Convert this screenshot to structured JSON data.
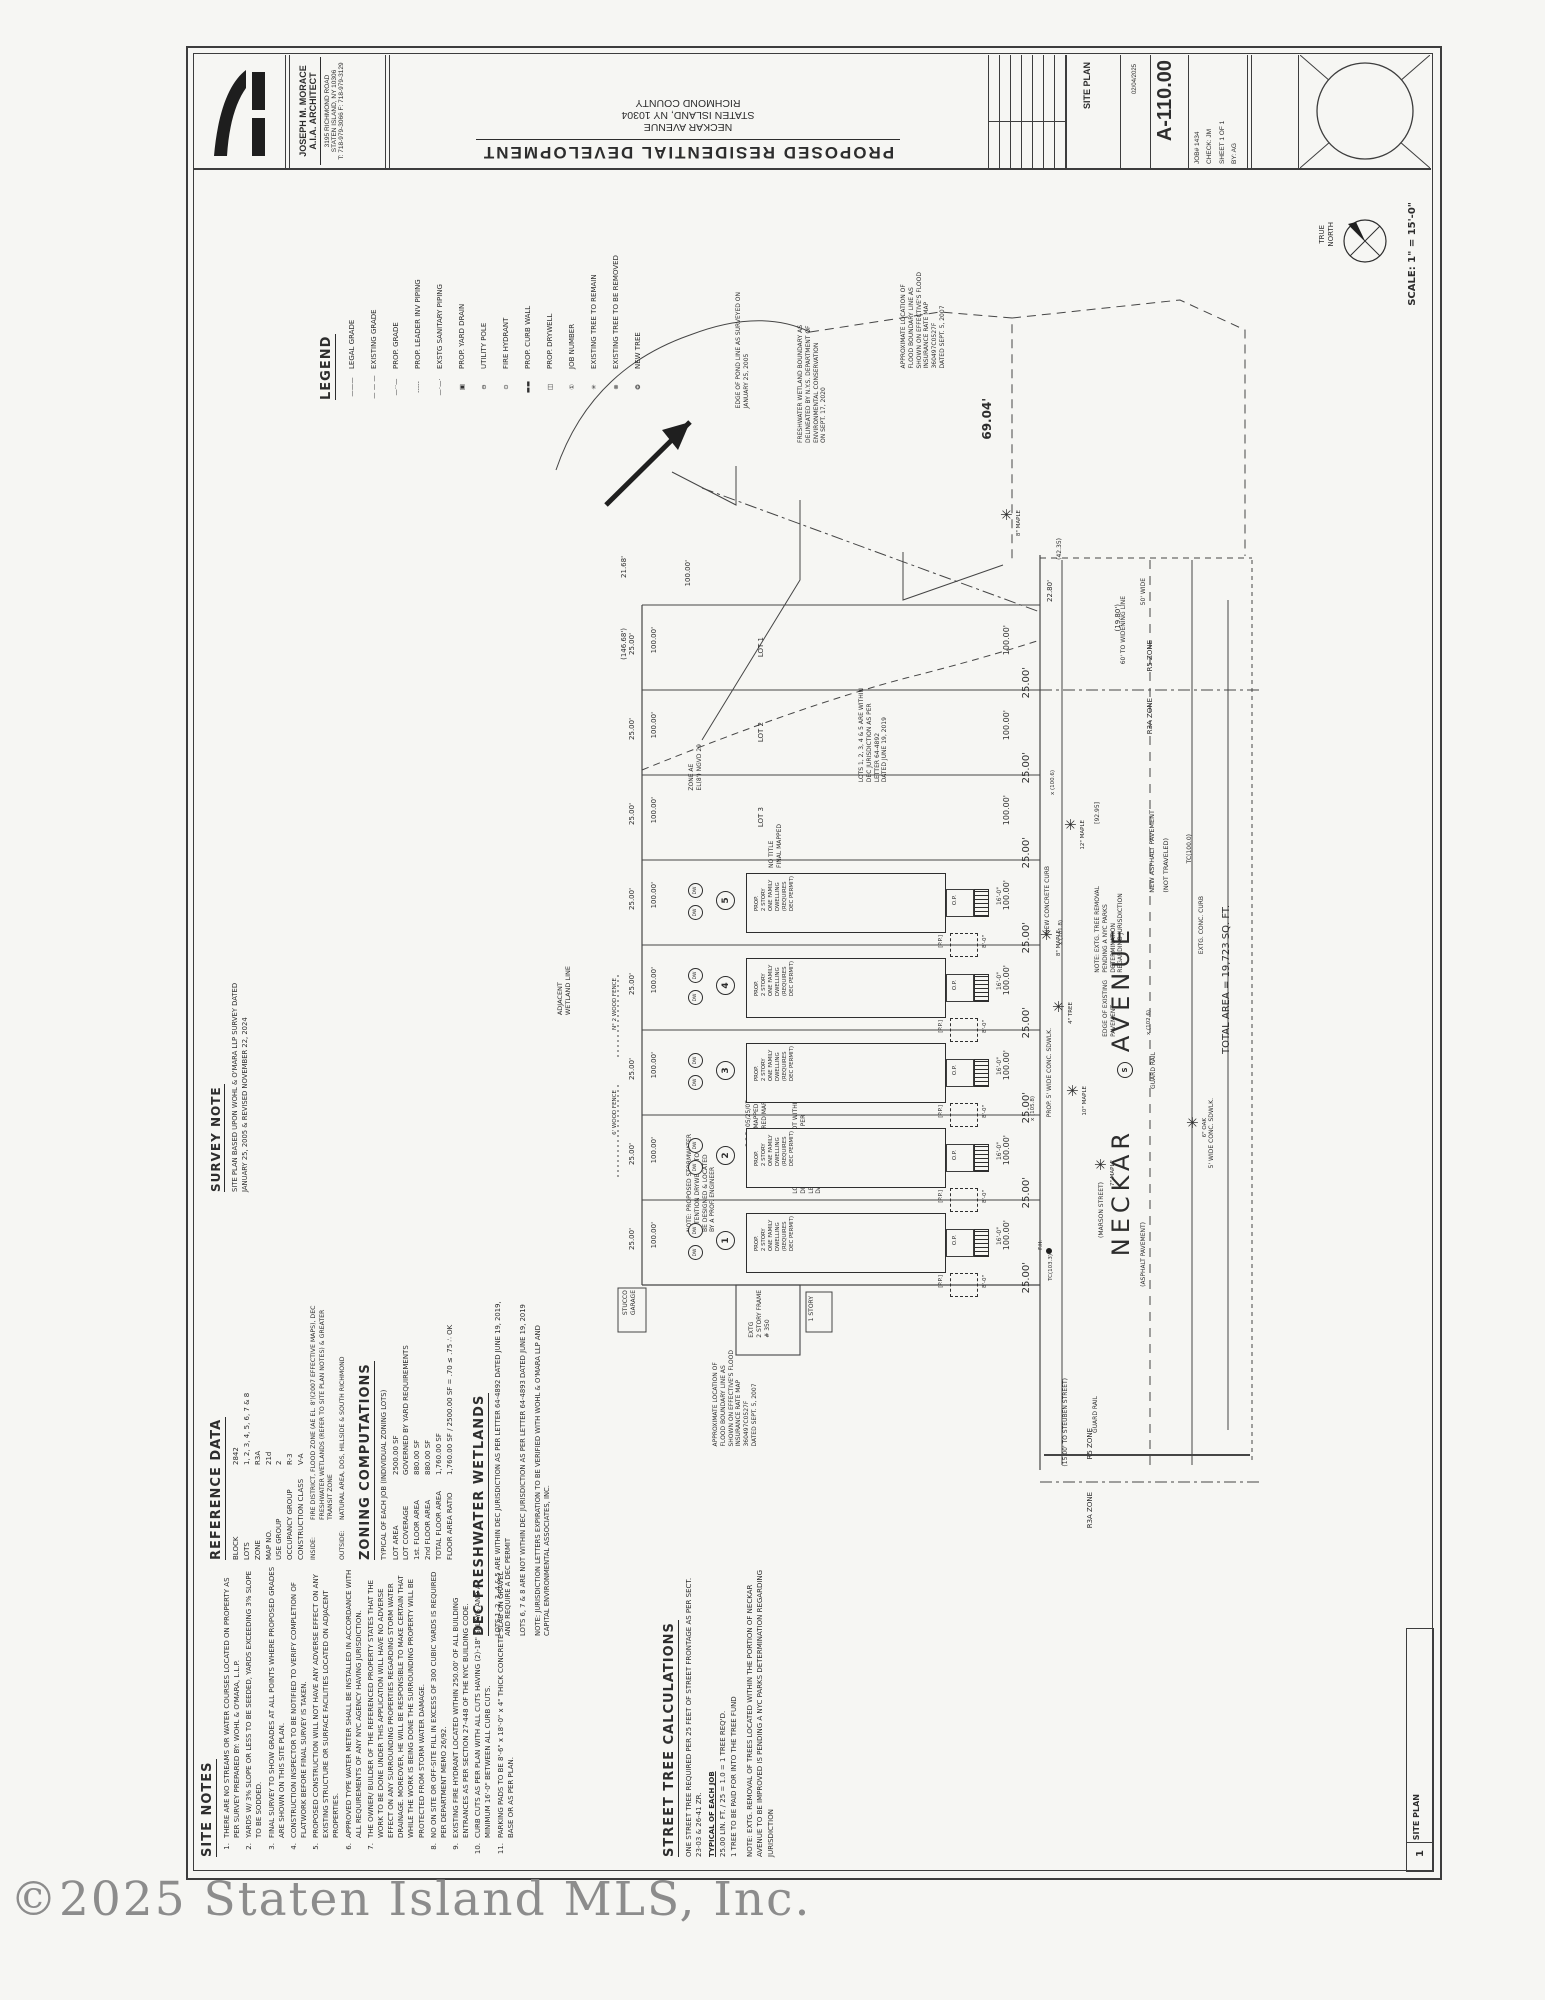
{
  "title_block": {
    "architect": {
      "name": "JOSEPH M. MORACE",
      "title": "A.I.A. ARCHITECT",
      "address1": "3195 RICHMOND ROAD",
      "address2": "STATEN ISLAND, NY 10306",
      "address3": "T: 718-979-3066   F: 718-979-3129"
    },
    "project": {
      "title": "PROPOSED  RESIDENTIAL  DEVELOPMENT",
      "address_lines": [
        "NECKAR AVENUE",
        "STATEN ISLAND, NY 10304",
        "RICHMOND COUNTY"
      ]
    },
    "site_plan_label": "SITE PLAN",
    "date": "02/04/2025",
    "sheet_number": "A-110.00",
    "job_lines": [
      "JOB# 1434",
      "CHECK: JM",
      "SHEET 1 OF 1",
      "BY: AG"
    ]
  },
  "legend": {
    "header": "LEGEND",
    "items": [
      {
        "sym": "———",
        "label": "LEGAL GRADE"
      },
      {
        "sym": "— — —",
        "label": "EXISTING GRADE"
      },
      {
        "sym": "—··—",
        "label": "PROP. GRADE"
      },
      {
        "sym": "-----",
        "label": "PROP. LEADER INV PIPING"
      },
      {
        "sym": "—·—·",
        "label": "EXSTG SANITARY PIPING"
      },
      {
        "sym": "▣",
        "label": "PROP. YARD DRAIN"
      },
      {
        "sym": "⊖",
        "label": "UTILITY POLE"
      },
      {
        "sym": "⊙",
        "label": "FIRE HYDRANT"
      },
      {
        "sym": "▬▬",
        "label": "PROP. CURB WALL"
      },
      {
        "sym": "◫",
        "label": "PROP. DRYWELL"
      },
      {
        "sym": "①",
        "label": "JOB NUMBER"
      },
      {
        "sym": "✳",
        "label": "EXISTING TREE TO REMAIN"
      },
      {
        "sym": "⊗",
        "label": "EXISTING TREE TO BE REMOVED"
      },
      {
        "sym": "❂",
        "label": "NEW TREE"
      }
    ]
  },
  "survey_note": {
    "header": "SURVEY NOTE",
    "text": "SITE PLAN BASED UPON WOHL & O'MARA LLP SURVEY DATED\nJANUARY 25, 2005 & REVISED NOVEMBER 22, 2024"
  },
  "reference_data": {
    "header": "REFERENCE DATA",
    "rows": [
      {
        "label": "BLOCK",
        "value": "2842"
      },
      {
        "label": "LOTS",
        "value": "1, 2, 3, 4, 5, 6, 7 & 8"
      },
      {
        "label": "ZONE",
        "value": "R3A"
      },
      {
        "label": "MAP NO.",
        "value": "21d"
      },
      {
        "label": "USE GROUP",
        "value": "2"
      },
      {
        "label": "OCCUPANCY GROUP",
        "value": "R-3"
      },
      {
        "label": "CONSTRUCTION CLASS",
        "value": "V-A"
      }
    ],
    "inside_label": "INSIDE:",
    "inside_value": "FIRE DISTRICT, FLOOD ZONE (AE EL. 8')(2007 EFFECTIVE MAPS), DEC FRESHWATER WETLANDS (REFER TO SITE PLAN NOTES) & GREATER TRANSIT ZONE",
    "outside_label": "OUTSIDE:",
    "outside_value": "NATURAL AREA, DOS, HILLSIDE & SOUTH RICHMOND"
  },
  "zoning": {
    "header": "ZONING COMPUTATIONS",
    "subtitle": "TYPICAL OF EACH JOB (INDIVIDUAL ZONING LOTS)",
    "rows": [
      {
        "label": "LOT AREA",
        "value": "2500.00 SF"
      },
      {
        "label": "LOT COVERAGE",
        "value": "GOVERNED BY YARD REQUIREMENTS"
      },
      {
        "label": "1st. FLOOR AREA",
        "value": "880.00 SF"
      },
      {
        "label": "2nd FLOOR AREA",
        "value": "880.00 SF"
      },
      {
        "label": "TOTAL FLOOR AREA",
        "value": "1,760.00 SF"
      },
      {
        "label": "FLOOR AREA RATIO",
        "value": "1,760.00 SF / 2500.00 SF = .70 ≤ .75 ∴ OK"
      }
    ]
  },
  "dec_wetlands": {
    "header": "DEC FRESHWATER WETLANDS",
    "paragraphs": [
      "LOTS 1, 2, 3, 4 & 5 ARE WITHIN DEC JURISDICTION AS PER LETTER 64-4892 DATED JUNE 19, 2019, AND REQUIRE A DEC PERMIT",
      "LOTS 6, 7 & 8 ARE NOT WITHIN DEC JURISDICTION AS PER LETTER 64-4893 DATED JUNE 19, 2019",
      "NOTE: JURISDICTION LETTERS EXPIRATION TO BE VERIFIED WITH WOHL & O'MARA LLP AND CAPITAL ENVIRONMENTAL ASSOCIATES, INC."
    ]
  },
  "site_notes": {
    "header": "SITE NOTES",
    "notes": [
      "THERE ARE NO STREAMS OR WATER COURSES LOCATED ON PROPERTY AS PER SURVEY PREPARED BY: WOHL & O'MARA, L.L.P.",
      "YARDS W/ 3% SLOPE OR LESS TO BE SEEDED, YARDS EXCEEDING 3% SLOPE TO BE SODDED.",
      "FINAL SURVEY TO SHOW GRADES AT ALL POINTS WHERE PROPOSED GRADES ARE SHOWN ON THIS SITE PLAN.",
      "CONSTRUCTION INSPECTOR TO BE NOTIFIED TO VERIFY COMPLETION OF FLATWORK BEFORE FINAL SURVEY IS TAKEN.",
      "PROPOSED CONSTRUCTION WILL NOT HAVE ANY ADVERSE EFFECT ON ANY EXISTING STRUCTURE OR SURFACE FACILITIES LOCATED ON ADJACENT PROPERTIES.",
      "APPROVED TYPE WATER METER SHALL BE INSTALLED IN ACCORDANCE WITH ALL REQUIREMENTS OF ANY NYC AGENCY HAVING JURISDICTION.",
      "THE OWNER/ BUILDER OF THE REFERENCED PROPERTY STATES THAT THE WORK TO BE DONE UNDER THIS APPLICATION WILL HAVE NO ADVERSE EFFECT ON ANY SURROUNDING PROPERTIES REGARDING STORM WATER DRAINAGE. MOREOVER, HE WILL BE RESPONSIBLE TO MAKE CERTAIN THAT WHILE THE WORK IS BEING DONE THE SURROUNDING PROPERTY WILL BE PROTECTED FROM STORM WATER DAMAGE.",
      "NO ON SITE OR OFF-SITE FILL IN EXCESS OF 300 CUBIC YARDS IS REQUIRED PER DEPARTMENT MEMO 26/92.",
      "EXISTING FIRE HYDRANT LOCATED WITHIN 250.00' OF ALL BUILDING ENTRANCES AS PER SECTION 27-448 OF THE NYC BUILDING CODE.",
      "CURB CUTS AS PER PLAN WITH ALL CUTS HAVING (2)-18\" SPLAYS AND A MINIMUM 16'-0\" BETWEEN ALL CURB CUTS.",
      "PARKING PADS TO BE 8'-6\" x 18'-0\" x 4\" THICK CONCRETE SLAB ON GRAVEL BASE OR AS PER PLAN."
    ]
  },
  "street_trees": {
    "header": "STREET TREE CALCULATIONS",
    "intro": "ONE STREET TREE REQUIRED PER 25 FEET OF STREET FRONTAGE AS PER SECT. 23-03 & 26-41 ZR.",
    "subtitle": "TYPICAL OF EACH JOB",
    "lines": [
      "25.00 LIN. FT. / 25 = 1.0 = 1 TREE REQ'D.",
      "1 TREE TO BE PAID FOR INTO THE TREE FUND"
    ],
    "note": "NOTE: EXTG. REMOVAL OF TREES LOCATED WITHIN THE PORTION OF NECKAR AVENUE TO BE IMPROVED IS PENDING A NYC PARKS DETERMINATION REGARDING JURISDICTION"
  },
  "footer": {
    "scale": "SCALE: 1\" = 15'-0\"",
    "north_label": "TRUE\nNORTH",
    "tag_number": "1",
    "tag_label": "SITE PLAN"
  },
  "watermark": "©2025 Staten Island MLS, Inc.",
  "plan": {
    "street_name": "NECKAR      AVENUE",
    "dwelling": {
      "x": 746,
      "w": 198,
      "h": 58,
      "ys": [
        873,
        958,
        1043,
        1128,
        1213
      ],
      "nums": [
        "5",
        "4",
        "3",
        "2",
        "1"
      ],
      "text": "PROP.\n2 STORY\nONE FAMILY\nDWELLING\n(REQUIRES\nDEC PERMIT)",
      "porch": "O.P.",
      "pp": "[P.P.]",
      "pp_dim": "8'-0\"",
      "front_dim": "16'-0\"",
      "dw": "DW"
    },
    "rows": {
      "count": 8,
      "y0": 605,
      "pitch": 85,
      "lot_prefix": "LOT",
      "left25": "25.00'",
      "left100": "100.00'",
      "right100": "100.00'",
      "right25": "25.00'"
    },
    "labels": [
      {
        "t": "EDGE OF POND LINE AS SURVEYED ON\nJANUARY 25, 2005",
        "x": 735,
        "y": 292,
        "fs": 6
      },
      {
        "t": "FRESHWATER WETLAND BOUNDARY AS\nDELINEATED BY N.Y.S. DEPARTMENT OF\nENVIRONMENTAL CONSERVATION\nON SEPT. 17, 2020",
        "x": 797,
        "y": 325,
        "fs": 6
      },
      {
        "t": "APPROXIMATE LOCATION OF\nFLOOD BOUNDARY LINE AS\nSHOWN ON EFFECTIVE'S FLOOD\nINSURANCE RATE MAP\n360497C0527F\nDATED SEPT. 5, 2007",
        "x": 900,
        "y": 272,
        "fs": 6
      },
      {
        "t": "69.04'",
        "x": 980,
        "y": 398,
        "fs": 12,
        "cls": "b"
      },
      {
        "t": "(MARSON STREET)",
        "x": 1098,
        "y": 1182,
        "fs": 6
      },
      {
        "t": "TOTAL AREA = 19,723 SQ. FT.",
        "x": 1220,
        "y": 905,
        "fs": 10
      },
      {
        "t": "EXTG. CONC. CURB",
        "x": 1198,
        "y": 896,
        "fs": 6
      },
      {
        "t": "TC(100.0)",
        "x": 1186,
        "y": 834,
        "fs": 6
      },
      {
        "t": "NEW ASPHALT PAVEMENT",
        "x": 1148,
        "y": 810,
        "fs": 6.5
      },
      {
        "t": "(NOT TRAVELED)",
        "x": 1162,
        "y": 838,
        "fs": 6.5
      },
      {
        "t": "NOTE: EXTG. TREE REMOVAL\nPENDING A NYC PARKS\nDETERMINATION\nREGARDING JURISDICTION",
        "x": 1094,
        "y": 886,
        "fs": 6
      },
      {
        "t": "NEW CONCRETE CURB",
        "x": 1044,
        "y": 866,
        "fs": 6
      },
      {
        "t": "PROP. 5' WIDE CONC. SDWLK.",
        "x": 1046,
        "y": 1028,
        "fs": 6
      },
      {
        "t": "5' WIDE CONC. SDWLK.",
        "x": 1208,
        "y": 1098,
        "fs": 6
      },
      {
        "t": "EDGE OF EXISTING\nPAVEMENT",
        "x": 1102,
        "y": 980,
        "fs": 6
      },
      {
        "t": "GUARD RAIL",
        "x": 1150,
        "y": 1052,
        "fs": 6
      },
      {
        "t": "GUARD RAIL",
        "x": 1092,
        "y": 1396,
        "fs": 6
      },
      {
        "t": "(15.00' TO STEUBEN STREET)",
        "x": 1062,
        "y": 1378,
        "fs": 6
      },
      {
        "t": "(ASPHALT PAVEMENT)",
        "x": 1140,
        "y": 1222,
        "fs": 6
      },
      {
        "t": "ZONE AE\nEL(8') NGVD 29",
        "x": 688,
        "y": 744,
        "fs": 6
      },
      {
        "t": "ADJACENT\nWETLAND LINE",
        "x": 556,
        "y": 966,
        "fs": 6.5
      },
      {
        "t": "NOTE: PROPOSED STORMWATER\nRETENTION DRYWELLS TO\nBE DESIGNED & LOCATED\nBY A PROF. ENGINEER",
        "x": 686,
        "y": 1134,
        "fs": 6
      },
      {
        "t": "LOTS 6, 7, & 8 ARE NOT WITHIN\nDEC JURISDICTION AS PER\nLETTER 64-4893\nDATED JUNE 19, 2014",
        "x": 792,
        "y": 1098,
        "fs": 6
      },
      {
        "t": "LOTS 1, 2, 3, 4 & 5 ARE WITHIN\nDEC JURISDICTION AS PER\nLETTER 64-4892\nDATED JUNE 19, 2019",
        "x": 858,
        "y": 688,
        "fs": 6
      },
      {
        "t": "C.C.D. 05/25/07\nFINAL MAPPED\nREQUIRED MAP",
        "x": 745,
        "y": 1100,
        "fs": 6
      },
      {
        "t": "NO TITLE\nFINAL MAPPED",
        "x": 768,
        "y": 824,
        "fs": 6
      },
      {
        "t": "APPROXIMATE LOCATION OF\nFLOOD BOUNDARY LINE AS\nSHOWN ON EFFECTIVE'S FLOOD\nINSURANCE RATE MAP\n360497C0527F\nDATED SEPT. 5, 2007",
        "x": 712,
        "y": 1350,
        "fs": 6
      },
      {
        "t": "EXTG\n2 STORY FRAME\n# 350",
        "x": 748,
        "y": 1290,
        "fs": 6
      },
      {
        "t": "1 STORY",
        "x": 808,
        "y": 1296,
        "fs": 6
      },
      {
        "t": "STUCCO\nGARAGE",
        "x": 622,
        "y": 1290,
        "fs": 6
      },
      {
        "t": "R5 ZONE",
        "x": 1146,
        "y": 640,
        "fs": 7,
        "n": "zone-label"
      },
      {
        "t": "R3A ZONE",
        "x": 1146,
        "y": 698,
        "fs": 7,
        "n": "zone-label"
      },
      {
        "t": "R5 ZONE",
        "x": 1086,
        "y": 1428,
        "fs": 7,
        "n": "zone-label"
      },
      {
        "t": "R3A ZONE",
        "x": 1086,
        "y": 1492,
        "fs": 7,
        "n": "zone-label"
      },
      {
        "t": "60' TO WIDENING LINE",
        "x": 1120,
        "y": 596,
        "fs": 6
      },
      {
        "t": "50' WIDE",
        "x": 1140,
        "y": 578,
        "fs": 6
      },
      {
        "t": "(42.35)",
        "x": 1056,
        "y": 538,
        "fs": 6
      },
      {
        "t": "22.80'",
        "x": 1046,
        "y": 580,
        "fs": 7
      },
      {
        "t": "(19.80')",
        "x": 1114,
        "y": 604,
        "fs": 7
      },
      {
        "t": "[92.95]",
        "x": 1094,
        "y": 802,
        "fs": 6
      },
      {
        "t": "(146.68')",
        "x": 620,
        "y": 628,
        "fs": 7
      },
      {
        "t": "21.68'",
        "x": 620,
        "y": 556,
        "fs": 7
      },
      {
        "t": "100.00'",
        "x": 684,
        "y": 560,
        "fs": 7
      },
      {
        "t": "x (100.6)",
        "x": 1050,
        "y": 770,
        "fs": 5.5
      },
      {
        "t": "x (102.6)",
        "x": 1146,
        "y": 1010,
        "fs": 5.5
      },
      {
        "t": "x (105.8)",
        "x": 1030,
        "y": 1096,
        "fs": 5.5
      },
      {
        "t": "x (101.8)",
        "x": 1058,
        "y": 920,
        "fs": 5.5
      },
      {
        "t": "6' WOOD FENCE",
        "x": 612,
        "y": 1090,
        "fs": 5.5
      },
      {
        "t": "N° 2 WOOD FENCE",
        "x": 612,
        "y": 978,
        "fs": 5.5
      },
      {
        "t": "F.H.",
        "x": 1038,
        "y": 1240,
        "fs": 5.5
      },
      {
        "t": "TC(103.3)",
        "x": 1048,
        "y": 1254,
        "fs": 5.5
      }
    ],
    "trees": [
      {
        "x": 1072,
        "y": 826,
        "t": "12\" MAPLE"
      },
      {
        "x": 1048,
        "y": 936,
        "t": "8\" MAPLE"
      },
      {
        "x": 1074,
        "y": 1092,
        "t": "10\" MAPLE"
      },
      {
        "x": 1102,
        "y": 1166,
        "t": "7\" MAPLE"
      },
      {
        "x": 1194,
        "y": 1124,
        "t": "6\" OAK"
      },
      {
        "x": 1008,
        "y": 516,
        "t": "8\" MAPLE"
      },
      {
        "x": 1060,
        "y": 1008,
        "t": "4\" TREE"
      }
    ],
    "sewer_mark": "S"
  }
}
